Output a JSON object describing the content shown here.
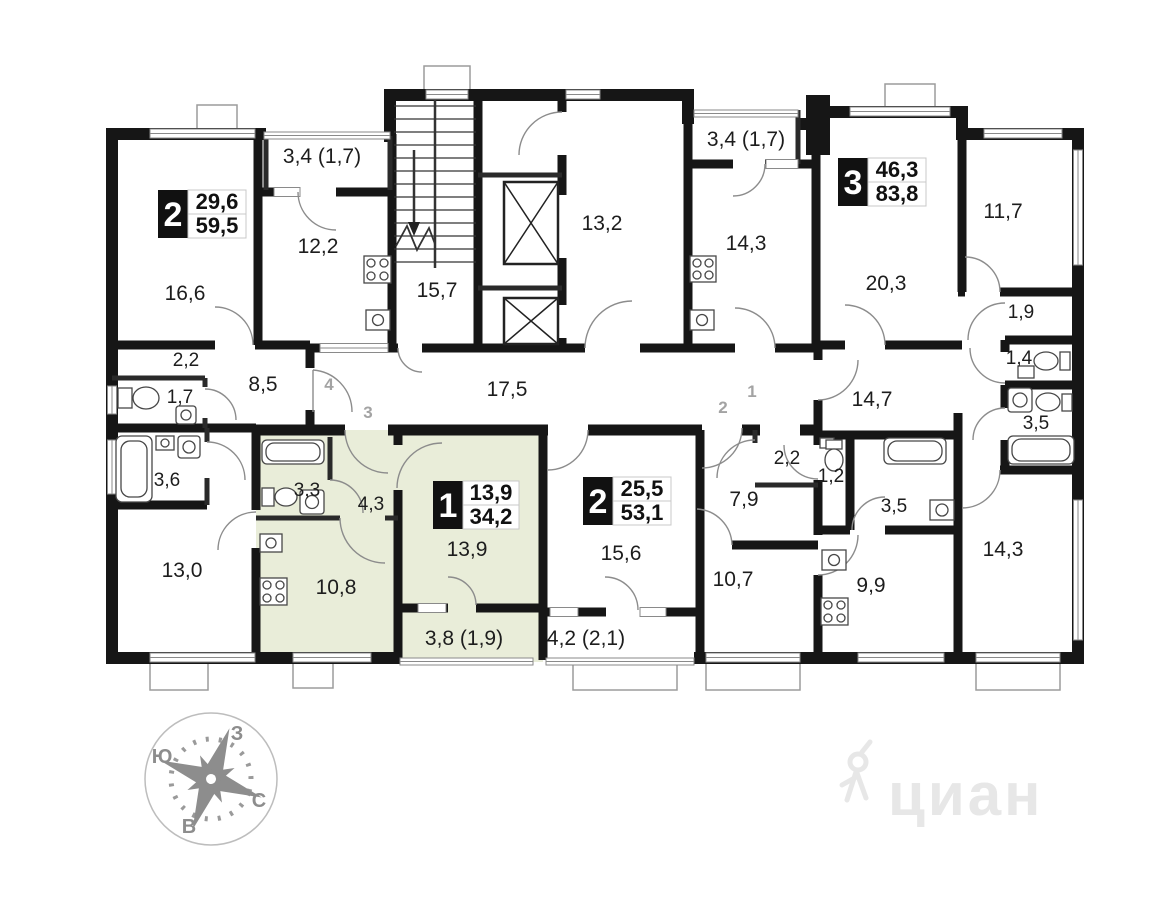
{
  "apartments": [
    {
      "type": "2",
      "living_area": "29,6",
      "total_area": "59,5"
    },
    {
      "type": "3",
      "living_area": "46,3",
      "total_area": "83,8"
    },
    {
      "type": "1",
      "living_area": "13,9",
      "total_area": "34,2"
    },
    {
      "type": "2",
      "living_area": "25,5",
      "total_area": "53,1"
    }
  ],
  "rooms": {
    "r16_6": "16,6",
    "bal_left": "3,4 (1,7)",
    "r12_2": "12,2",
    "stairs": "15,7",
    "hall13_2": "13,2",
    "bal_mid": "3,4 (1,7)",
    "k14_3": "14,3",
    "r20_3": "20,3",
    "r11_7": "11,7",
    "h2_2l": "2,2",
    "wc1_7": "1,7",
    "h8_5": "8,5",
    "cor17_5": "17,5",
    "b3_6": "3,6",
    "r13_0": "13,0",
    "b3_3": "3,3",
    "h4_3": "4,3",
    "k10_8": "10,8",
    "r13_9": "13,9",
    "bal3_8": "3,8 (1,9)",
    "r15_6": "15,6",
    "bal4_2": "4,2 (2,1)",
    "h2_2r": "2,2",
    "h7_9": "7,9",
    "wc1_2": "1,2",
    "b3_5l": "3,5",
    "r10_7": "10,7",
    "k9_9": "9,9",
    "cor14_7": "14,7",
    "h1_9": "1,9",
    "wc1_4": "1,4",
    "b3_5r": "3,5",
    "r14_3": "14,3"
  },
  "entrances": {
    "e1": "1",
    "e2": "2",
    "e3": "3",
    "e4": "4"
  },
  "compass": {
    "north": "С",
    "south": "Ю",
    "west": "З",
    "east": "В"
  },
  "watermark": {
    "text": "циан"
  },
  "colors": {
    "highlight": "#e9edd9",
    "wall": "#161616",
    "entrance": "#a3a3a3",
    "watermark": "#e7e7e7"
  }
}
